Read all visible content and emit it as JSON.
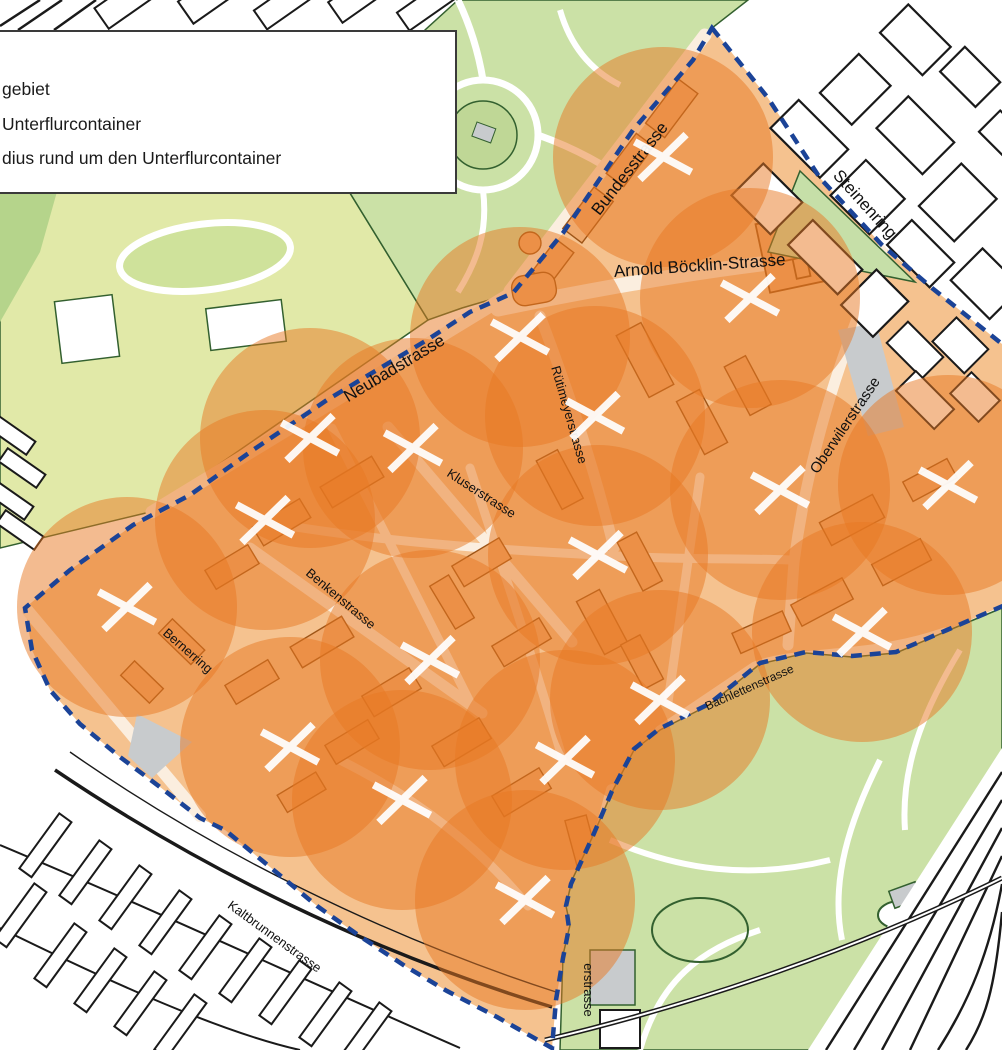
{
  "legend": {
    "items": [
      "gebiet",
      "Unterflurcontainer",
      "dius rund um den Unterflurcontainer"
    ]
  },
  "map": {
    "colors": {
      "coverage_orange": "#E87722",
      "boundary_blue": "#1B4397",
      "building_fill": "#F0A96C",
      "building_stroke": "#9E5517",
      "pilot_base": "#F5C28F",
      "street_light": "#FBEEDF",
      "park_green": "#CBE1A6",
      "park_dark_green": "#B5D48B",
      "sports_green": "#E1E9A8",
      "park_outline": "#33602F",
      "outline_black": "#1A1A1A",
      "grey": "#C8CBCD",
      "label_color": "#111111",
      "marker_white": "#FFFFFF"
    },
    "boundary": {
      "style": "dashed"
    },
    "containers": {
      "symbol": "white-x-cross",
      "radius_px": 110,
      "opacity": 0.5,
      "points": [
        [
          663,
          157
        ],
        [
          750,
          298
        ],
        [
          520,
          337
        ],
        [
          595,
          416
        ],
        [
          310,
          438
        ],
        [
          413,
          448
        ],
        [
          265,
          520
        ],
        [
          948,
          485
        ],
        [
          780,
          490
        ],
        [
          598,
          555
        ],
        [
          862,
          632
        ],
        [
          127,
          607
        ],
        [
          430,
          660
        ],
        [
          660,
          700
        ],
        [
          290,
          747
        ],
        [
          565,
          760
        ],
        [
          402,
          800
        ],
        [
          525,
          900
        ]
      ]
    },
    "street_labels": [
      {
        "name": "Bundesstrasse",
        "x": 634,
        "y": 172,
        "rot": -52,
        "size": 17
      },
      {
        "name": "Steinenring",
        "x": 861,
        "y": 208,
        "rot": 48,
        "size": 17
      },
      {
        "name": "Arnold Böcklin-Strasse",
        "x": 700,
        "y": 271,
        "rot": -4,
        "size": 17
      },
      {
        "name": "Neubadstrasse",
        "x": 397,
        "y": 373,
        "rot": -31,
        "size": 17
      },
      {
        "name": "Rütimeyerstrasse",
        "x": 565,
        "y": 416,
        "rot": 74,
        "size": 13
      },
      {
        "name": "Kluserstrasse",
        "x": 479,
        "y": 497,
        "rot": 33,
        "size": 13
      },
      {
        "name": "Oberwilerstrasse",
        "x": 849,
        "y": 428,
        "rot": -56,
        "size": 15
      },
      {
        "name": "Benkenstrasse",
        "x": 338,
        "y": 602,
        "rot": 40,
        "size": 13
      },
      {
        "name": "Bernerring",
        "x": 185,
        "y": 654,
        "rot": 41,
        "size": 13
      },
      {
        "name": "Bachlettenstrasse",
        "x": 751,
        "y": 691,
        "rot": -24,
        "size": 12
      },
      {
        "name": "Kaltbrunnenstrasse",
        "x": 272,
        "y": 940,
        "rot": 36,
        "size": 13
      },
      {
        "name": "erstrasse",
        "x": 584,
        "y": 990,
        "rot": 90,
        "size": 13
      }
    ]
  }
}
